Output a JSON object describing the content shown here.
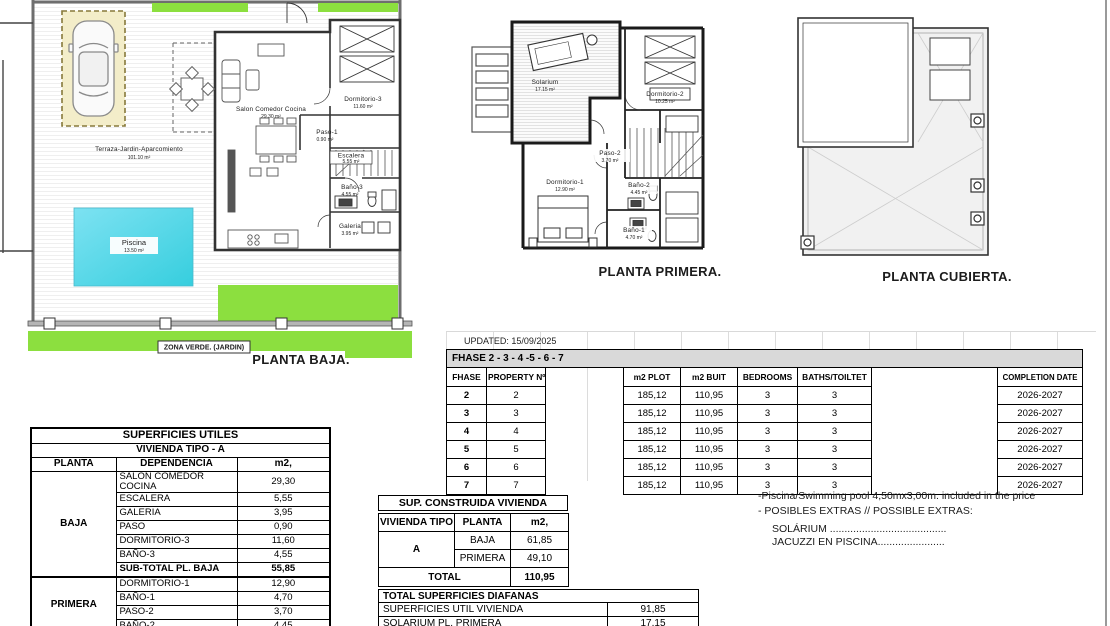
{
  "colors": {
    "green": "#8cdf3f",
    "pool_gradient_start": "#7de2f2",
    "pool_gradient_end": "#36cede",
    "parking_fill": "#f3edc9",
    "header_bar_gray": "#d9d9d9"
  },
  "plan_baja": {
    "title": "PLANTA BAJA.",
    "zona_verde": "ZONA VERDE. (JARDIN)",
    "terraza_label": "Terraza-Jardin-Aparcomiento",
    "terraza_area": "101.10 m²",
    "piscina_label": "Piscina",
    "piscina_area": "13.50 m²",
    "salon_label": "Salon Comedor Cocina",
    "salon_area": "29.30 m²",
    "dorm3_label": "Dormitorio-3",
    "dorm3_area": "11.60 m²",
    "paso1_label": "Paso-1",
    "paso1_area": "0.90 m²",
    "escalera_label": "Escalera",
    "escalera_area": "5.55 m²",
    "bano3_label": "Baño-3",
    "bano3_area": "4.55 m²",
    "galeria_label": "Galeria",
    "galeria_area": "3.95 m²"
  },
  "plan_primera": {
    "title": "PLANTA PRIMERA.",
    "solarium_label": "Solarium",
    "solarium_area": "17.15 m²",
    "dorm2_label": "Dormitorio-2",
    "dorm2_area": "10.25 m²",
    "paso2_label": "Paso-2",
    "paso2_area": "3.70 m²",
    "dorm1_label": "Dormitorio-1",
    "dorm1_area": "12.90 m²",
    "bano2_label": "Baño-2",
    "bano2_area": "4.45 m²",
    "bano1_label": "Baño-1",
    "bano1_area": "4.70 m²"
  },
  "plan_cubierta": {
    "title": "PLANTA CUBIERTA."
  },
  "phase_table": {
    "updated": "UPDATED: 15/09/2025",
    "title": "FHASE  2 - 3 - 4 -5 - 6 - 7",
    "headers": {
      "fhase": "FHASE",
      "property": "PROPERTY Nº",
      "plot": "m2 PLOT",
      "built": "m2 BUIT",
      "bedrooms": "BEDROOMS",
      "baths": "BATHS/TOILTET",
      "completion": "COMPLETION DATE"
    },
    "rows": [
      {
        "fhase": "2",
        "property": "2",
        "plot": "185,12",
        "built": "110,95",
        "bedrooms": "3",
        "baths": "3",
        "completion": "2026-2027"
      },
      {
        "fhase": "3",
        "property": "3",
        "plot": "185,12",
        "built": "110,95",
        "bedrooms": "3",
        "baths": "3",
        "completion": "2026-2027"
      },
      {
        "fhase": "4",
        "property": "4",
        "plot": "185,12",
        "built": "110,95",
        "bedrooms": "3",
        "baths": "3",
        "completion": "2026-2027"
      },
      {
        "fhase": "5",
        "property": "5",
        "plot": "185,12",
        "built": "110,95",
        "bedrooms": "3",
        "baths": "3",
        "completion": "2026-2027"
      },
      {
        "fhase": "6",
        "property": "6",
        "plot": "185,12",
        "built": "110,95",
        "bedrooms": "3",
        "baths": "3",
        "completion": "2026-2027"
      },
      {
        "fhase": "7",
        "property": "7",
        "plot": "185,12",
        "built": "110,95",
        "bedrooms": "3",
        "baths": "3",
        "completion": "2026-2027"
      }
    ]
  },
  "superficies_utiles": {
    "title": "SUPERFICIES UTILES",
    "subtitle": "VIVIENDA TIPO - A",
    "col_planta": "PLANTA",
    "col_dependencia": "DEPENDENCIA",
    "col_m2": "m2,",
    "baja_label": "BAJA",
    "baja_rows": [
      {
        "name": "SALON COMEDOR COCINA",
        "m2": "29,30"
      },
      {
        "name": "ESCALERA",
        "m2": "5,55"
      },
      {
        "name": "GALERIA",
        "m2": "3,95"
      },
      {
        "name": "PASO",
        "m2": "0,90"
      },
      {
        "name": "DORMITORIO-3",
        "m2": "11,60"
      },
      {
        "name": "BAÑO-3",
        "m2": "4,55"
      }
    ],
    "subtotal_label": "SUB-TOTAL PL. BAJA",
    "subtotal_value": "55,85",
    "primera_label": "PRIMERA",
    "primera_rows": [
      {
        "name": "DORMITORIO-1",
        "m2": "12,90"
      },
      {
        "name": "BAÑO-1",
        "m2": "4,70"
      },
      {
        "name": "PASO-2",
        "m2": "3,70"
      },
      {
        "name": "BAÑO-2",
        "m2": "4,45"
      }
    ]
  },
  "sup_construida": {
    "title": "SUP. CONSTRUIDA VIVIENDA",
    "col_tipo": "VIVIENDA TIPO",
    "col_planta": "PLANTA",
    "col_m2": "m2,",
    "tipo": "A",
    "row_baja_label": "BAJA",
    "row_baja_value": "61,85",
    "row_primera_label": "PRIMERA",
    "row_primera_value": "49,10",
    "total_label": "TOTAL",
    "total_value": "110,95"
  },
  "diafanas": {
    "title": "TOTAL SUPERFICIES DIAFANAS",
    "row1_name": "SUPERFICIES UTIL VIVIENDA",
    "row1_value": "91,85",
    "row2_name": "SOLARIUM PL. PRIMERA",
    "row2_value": "17,15"
  },
  "extras": {
    "line1": "-Piscina/Swimming pool 4,50mx3,00m. included in the price",
    "line2": "- POSIBLES EXTRAS // POSSIBLE EXTRAS:",
    "line3": "SOLÁRIUM ........................................",
    "line4": "JACUZZI EN PISCINA......................."
  }
}
